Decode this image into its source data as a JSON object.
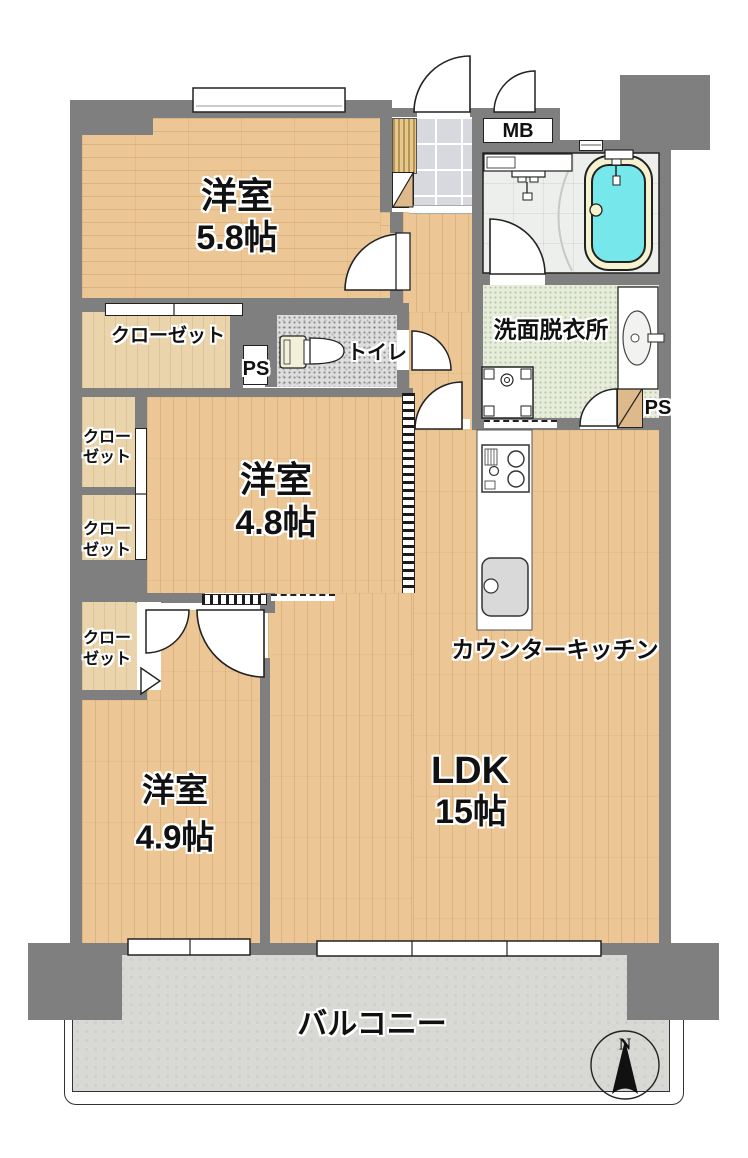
{
  "rooms": {
    "bedroom1": {
      "name": "洋室",
      "size": "5.8帖"
    },
    "bedroom2": {
      "name": "洋室",
      "size": "4.8帖"
    },
    "bedroom3": {
      "name": "洋室",
      "size": "4.9帖"
    },
    "ldk": {
      "name": "LDK",
      "size": "15帖"
    },
    "kitchen": {
      "label": "カウンターキッチン"
    },
    "washroom": {
      "label": "洗面脱衣所"
    },
    "toilet": {
      "label": "トイレ"
    },
    "closet": {
      "label": "クローゼット"
    },
    "closet_small": {
      "line1": "クロー",
      "line2": "ゼット"
    },
    "balcony": {
      "label": "バルコニー"
    }
  },
  "fixtures": {
    "mb": {
      "label": "MB"
    },
    "ps": {
      "label": "PS"
    }
  },
  "compass": {
    "north": "N"
  },
  "colors": {
    "wall": "#7f7f7f",
    "wood": "#ecc795",
    "wood_light": "#e9d4ab",
    "tub_water": "#76e7ea",
    "tub_rim": "#f6f2cf",
    "balcony": "#d8d9d4",
    "washroom_floor": "#e6edda",
    "toilet_floor": "#dedede",
    "cabinet": "#ddb98c"
  }
}
